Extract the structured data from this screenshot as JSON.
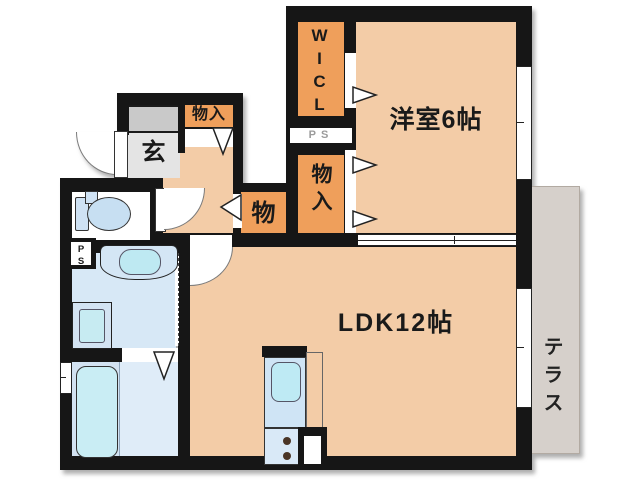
{
  "plan": {
    "rooms": {
      "western_room": "洋室6帖",
      "ldk": "LDK12帖",
      "entrance": "玄",
      "walk_in_closet": "WICL",
      "storage_top": "物入",
      "storage_hall": "物",
      "storage_column": "物入",
      "terrace": "テラス",
      "pipe_space_upper": "PS",
      "pipe_space_lower": "PS"
    },
    "fixtures": [
      "toilet",
      "washbasin",
      "washing-machine-pan",
      "bathtub",
      "kitchen-sink",
      "gas-stove",
      "pipe-shaft"
    ],
    "colors": {
      "wall": "#161616",
      "room_floor": "#F3CCA7",
      "closet": "#EF9F5B",
      "entrance_floor": "#E4E4E4",
      "entrance_step": "#C9C9C9",
      "wet_floor": "#D7E8F6",
      "fixture_water": "#BEE9F2",
      "terrace": "#D6D0CB"
    }
  }
}
